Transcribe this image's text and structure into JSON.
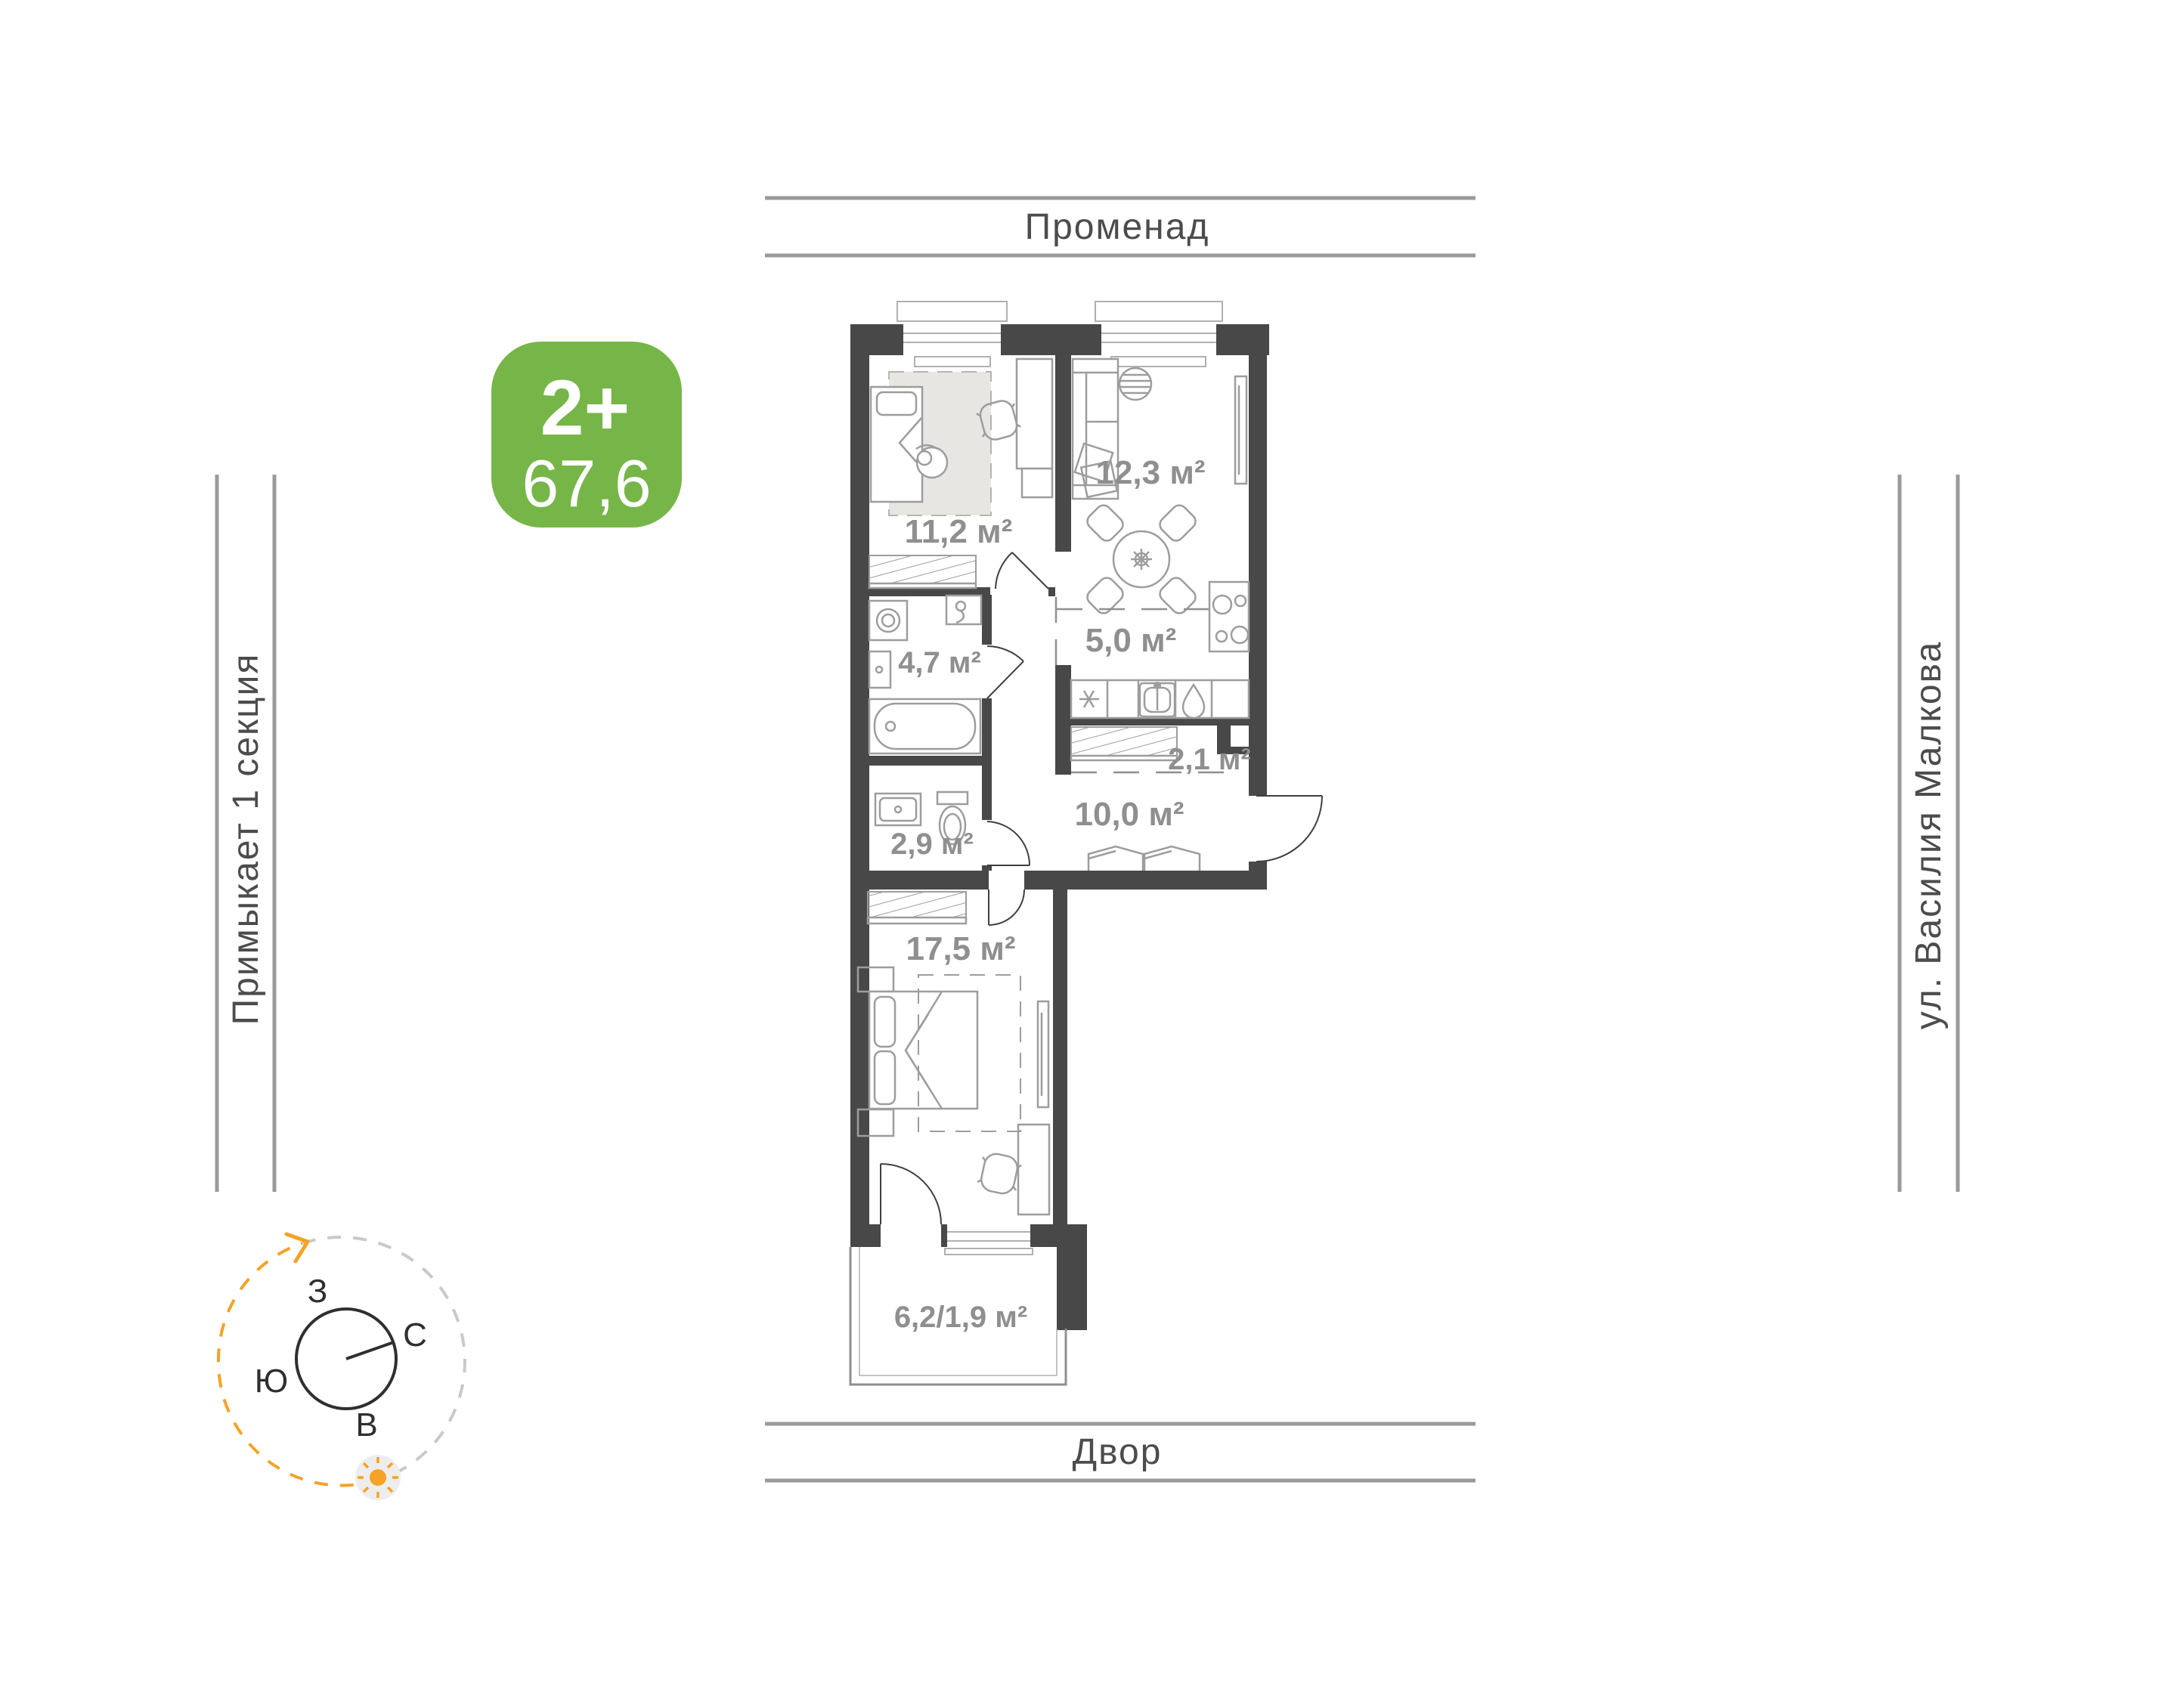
{
  "unit_card": {
    "type_label": "2+",
    "total_area": "67,6"
  },
  "surroundings": {
    "top_street": "Променад",
    "bottom_area": "Двор",
    "left_note": "Примыкает 1 секция",
    "right_street": "ул. Василия Малкова"
  },
  "compass": {
    "west": "З",
    "north": "С",
    "south": "Ю",
    "east": "В"
  },
  "rooms": [
    {
      "name": "room-11-2",
      "area": "11,2 м²"
    },
    {
      "name": "living-room",
      "area": "12,3 м²"
    },
    {
      "name": "bathroom",
      "area": "4,7 м²"
    },
    {
      "name": "kitchen",
      "area": "5,0 м²"
    },
    {
      "name": "wardrobe",
      "area": "2,1 м²"
    },
    {
      "name": "hallway",
      "area": "10,0 м²"
    },
    {
      "name": "wc",
      "area": "2,9 м²"
    },
    {
      "name": "bedroom",
      "area": "17,5 м²"
    },
    {
      "name": "balcony",
      "area": "6,2/1,9 м²"
    }
  ],
  "colors": {
    "accent_green": "#76B648",
    "accent_orange": "#F5A226",
    "wall": "#484848"
  }
}
